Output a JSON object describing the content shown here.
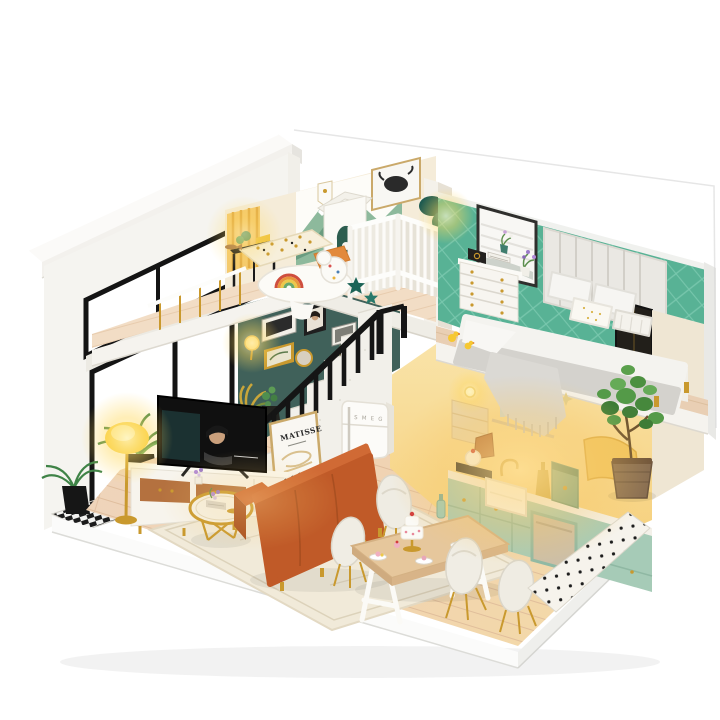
{
  "scene": {
    "description": "Photograph of a DIY miniature dollhouse loft: nursery and bedroom upstairs, living room, staircase, kitchen and dining area downstairs, warm LED lighting, white display base",
    "background_color": "#ffffff",
    "texts": {
      "poster_title": "MATISSE",
      "fridge_brand": "S M E G"
    },
    "palette": {
      "roof_white": "#f6f5f1",
      "gallery_wall_teal": "#40615a",
      "bedroom_wall_jade": "#58b295",
      "nursery_wall_cream": "#f5ecd9",
      "curtain_yellow": "#f4c96d",
      "sofa_orange": "#c05a28",
      "cabinet_mint": "#a6cbb7",
      "wood_floor": "#efd5ba",
      "accent_gold": "#c9992e",
      "lamp_glow": "#ffd95e",
      "railing_black": "#151515"
    },
    "rooms": [
      {
        "label": "nursery"
      },
      {
        "label": "bedroom"
      },
      {
        "label": "living room"
      },
      {
        "label": "kitchen"
      },
      {
        "label": "dining area"
      },
      {
        "label": "staircase"
      },
      {
        "label": "balcony"
      }
    ]
  }
}
